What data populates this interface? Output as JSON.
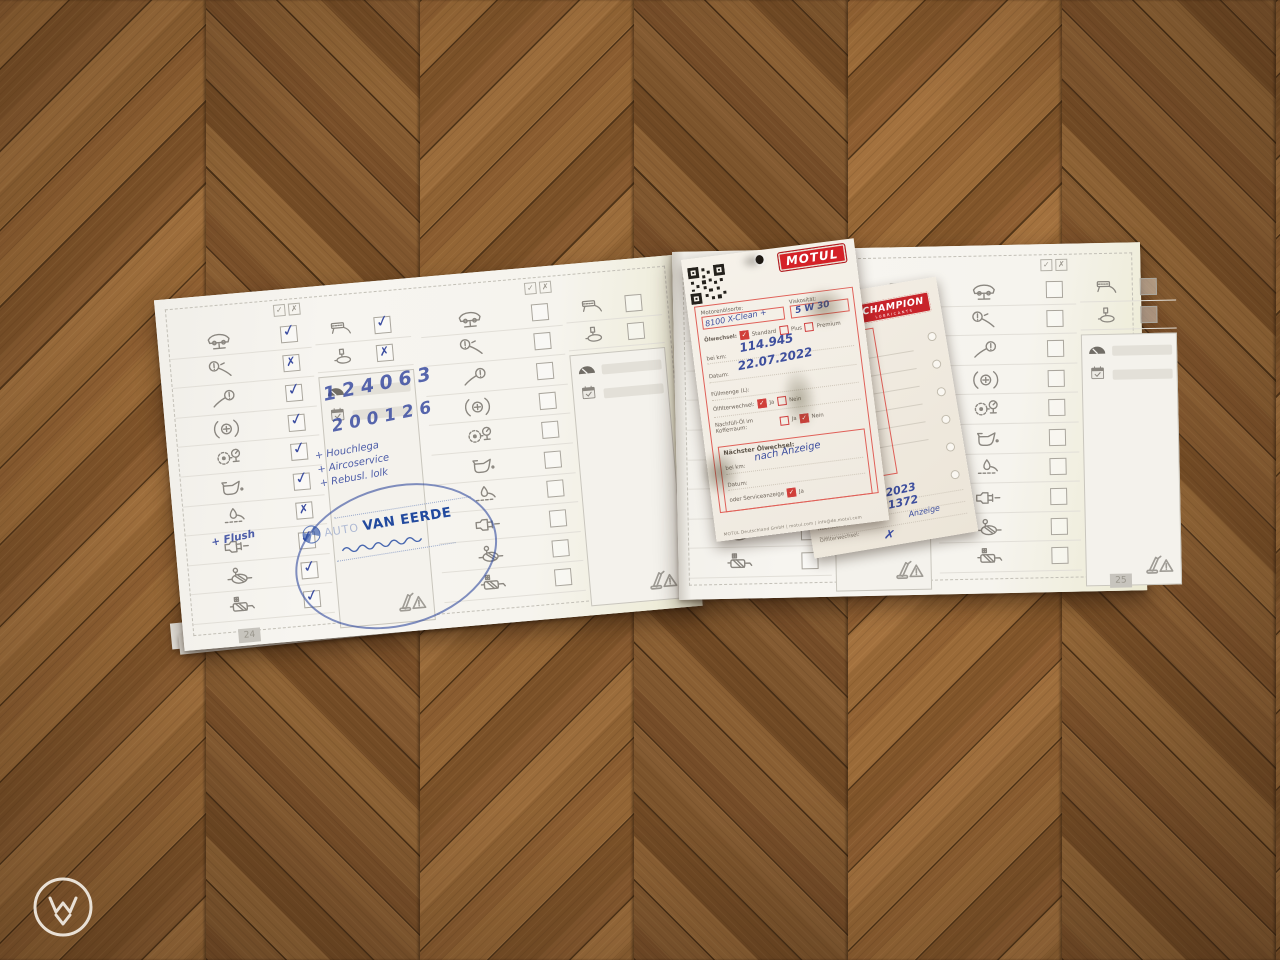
{
  "glyphs": {
    "check": "✓",
    "cross": "✗"
  },
  "booklet": {
    "legend": {
      "check": "✓",
      "cross": "✗"
    },
    "pages": [
      {
        "side": "left",
        "page_number": "24",
        "records": [
          {
            "rows": [
              {
                "icon": "car-on-lift",
                "mark": "check"
              },
              {
                "icon": "front-brake",
                "mark": "cross"
              },
              {
                "icon": "rear-brake",
                "mark": "check"
              },
              {
                "icon": "parking-brake",
                "mark": "check"
              },
              {
                "icon": "tire-pressure",
                "mark": "check"
              },
              {
                "icon": "oil-can",
                "mark": "check"
              },
              {
                "icon": "underbody-lube",
                "mark": "cross"
              },
              {
                "icon": "injector",
                "mark": "check"
              },
              {
                "icon": "front-muffler",
                "mark": "check"
              },
              {
                "icon": "rear-muffler",
                "mark": "check"
              }
            ],
            "extra_rows": [
              {
                "icon": "air-filter",
                "mark": "check"
              },
              {
                "icon": "fuel-filter",
                "mark": "cross"
              }
            ],
            "km": "124063",
            "date": "200126",
            "notes": [
              "+ Houchlega",
              "+ Aircoservice",
              "+ Rebusl. lolk"
            ],
            "oil_note": "+ Flush",
            "stamp": {
              "prefix": "AUTO",
              "name": "VAN EERDE"
            }
          },
          {
            "rows": [
              {
                "icon": "car-on-lift",
                "mark": "none"
              },
              {
                "icon": "front-brake",
                "mark": "none"
              },
              {
                "icon": "rear-brake",
                "mark": "none"
              },
              {
                "icon": "parking-brake",
                "mark": "none"
              },
              {
                "icon": "tire-pressure",
                "mark": "none"
              },
              {
                "icon": "oil-can",
                "mark": "none"
              },
              {
                "icon": "underbody-lube",
                "mark": "none"
              },
              {
                "icon": "injector",
                "mark": "none"
              },
              {
                "icon": "front-muffler",
                "mark": "none"
              },
              {
                "icon": "rear-muffler",
                "mark": "none"
              }
            ],
            "extra_rows": [
              {
                "icon": "air-filter",
                "mark": "none"
              },
              {
                "icon": "fuel-filter",
                "mark": "none"
              }
            ],
            "km": "",
            "date": "",
            "notes": []
          }
        ]
      },
      {
        "side": "right",
        "page_number": "25",
        "records": [
          {
            "rows": [
              {
                "icon": "car-on-lift",
                "mark": "none"
              },
              {
                "icon": "front-brake",
                "mark": "none"
              },
              {
                "icon": "rear-brake",
                "mark": "none"
              },
              {
                "icon": "parking-brake",
                "mark": "none"
              },
              {
                "icon": "tire-pressure",
                "mark": "none"
              },
              {
                "icon": "oil-can",
                "mark": "none"
              },
              {
                "icon": "underbody-lube",
                "mark": "none"
              },
              {
                "icon": "injector",
                "mark": "none"
              },
              {
                "icon": "front-muffler",
                "mark": "none"
              },
              {
                "icon": "rear-muffler",
                "mark": "none"
              }
            ],
            "extra_rows": [
              {
                "icon": "air-filter",
                "mark": "none"
              },
              {
                "icon": "fuel-filter",
                "mark": "none"
              }
            ],
            "km": "",
            "date": "",
            "notes": []
          },
          {
            "rows": [
              {
                "icon": "car-on-lift",
                "mark": "none"
              },
              {
                "icon": "front-brake",
                "mark": "none"
              },
              {
                "icon": "rear-brake",
                "mark": "none"
              },
              {
                "icon": "parking-brake",
                "mark": "none"
              },
              {
                "icon": "tire-pressure",
                "mark": "none"
              },
              {
                "icon": "oil-can",
                "mark": "none"
              },
              {
                "icon": "underbody-lube",
                "mark": "none"
              },
              {
                "icon": "injector",
                "mark": "none"
              },
              {
                "icon": "front-muffler",
                "mark": "none"
              },
              {
                "icon": "rear-muffler",
                "mark": "none"
              }
            ],
            "extra_rows": [
              {
                "icon": "air-filter",
                "mark": "none"
              },
              {
                "icon": "fuel-filter",
                "mark": "none"
              }
            ],
            "km": "",
            "date": "",
            "notes": []
          }
        ]
      }
    ]
  },
  "motul_card": {
    "brand": "MOTUL",
    "labels": {
      "oil_type": "Motorenölsorte:",
      "viscosity": "Viskosität:",
      "oil_change": "Ölwechsel:",
      "standard": "Standard",
      "plus": "Plus",
      "premium": "Premium",
      "at_km": "bei km:",
      "date": "Datum:",
      "fill_qty": "Füllmenge (L):",
      "filter_change": "Ölfilterwechsel:",
      "yes": "Ja",
      "no": "Nein",
      "refill_oil": "Nachfüll-Öl im Kofferraum:",
      "next_oil_change": "Nächster Ölwechsel:",
      "or_service": "oder Serviceanzeige",
      "footer": "MOTUL Deutschland GmbH  |  motul.com  |  info@de.motul.com"
    },
    "values": {
      "oil_type": "8100 X-Clean +",
      "viscosity": "5 W 30",
      "km": "114.945",
      "date": "22.07.2022",
      "next_km": "nach Anzeige"
    },
    "checks": {
      "standard": true,
      "plus": false,
      "premium": false,
      "filter_ja": true,
      "filter_nein": false,
      "refill_ja": false,
      "refill_nein": true,
      "service_ja": true
    }
  },
  "champion_card": {
    "brand": "CHAMPION",
    "sub_brand": "LUBRICANTS",
    "labels": {
      "date": "Datum:",
      "km": "Kilometerstand:",
      "next_km": "Nächster Ölwechsel bei km:",
      "filter": "Ölfilterwechsel:"
    },
    "values": {
      "date": "12.06.2023",
      "km": "121372",
      "next_km": "Anzeige",
      "filter_mark": "✗"
    }
  }
}
